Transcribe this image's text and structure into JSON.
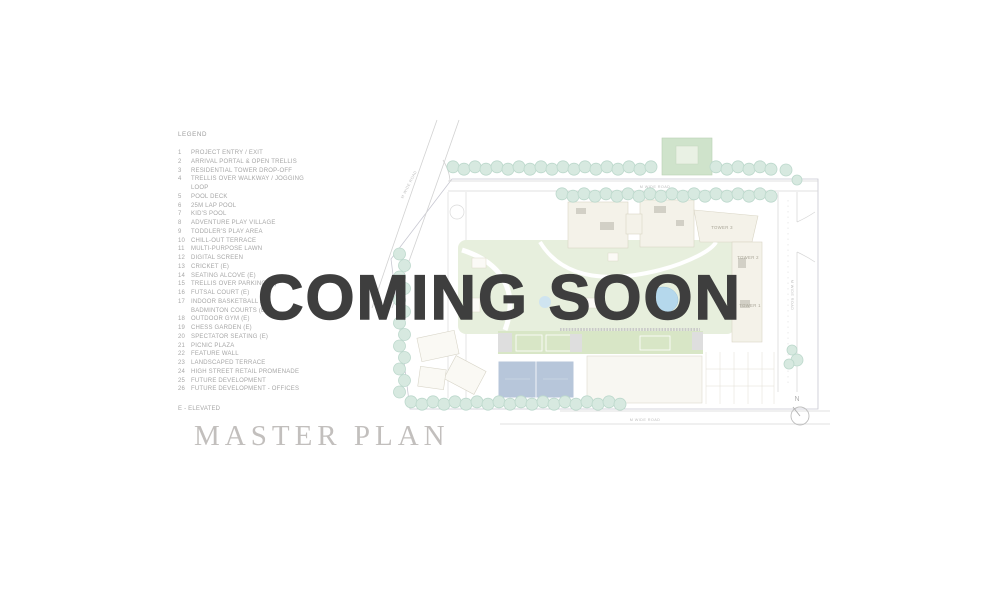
{
  "overlay": {
    "coming_soon": "COMING SOON"
  },
  "legend": {
    "heading": "LEGEND",
    "note": "E - ELEVATED",
    "items": [
      {
        "num": "1",
        "label": "PROJECT ENTRY / EXIT"
      },
      {
        "num": "2",
        "label": "ARRIVAL PORTAL & OPEN TRELLIS"
      },
      {
        "num": "3",
        "label": "RESIDENTIAL TOWER DROP-OFF"
      },
      {
        "num": "4",
        "label": "TRELLIS OVER WALKWAY / JOGGING LOOP"
      },
      {
        "num": "5",
        "label": "POOL DECK"
      },
      {
        "num": "6",
        "label": "25M LAP POOL"
      },
      {
        "num": "7",
        "label": "KID'S POOL"
      },
      {
        "num": "8",
        "label": "ADVENTURE PLAY VILLAGE"
      },
      {
        "num": "9",
        "label": "TODDLER'S PLAY AREA"
      },
      {
        "num": "10",
        "label": "CHILL-OUT TERRACE"
      },
      {
        "num": "11",
        "label": "MULTI-PURPOSE LAWN"
      },
      {
        "num": "12",
        "label": "DIGITAL SCREEN"
      },
      {
        "num": "13",
        "label": "CRICKET (E)"
      },
      {
        "num": "14",
        "label": "SEATING ALCOVE (E)"
      },
      {
        "num": "15",
        "label": "TRELLIS OVER PARKING (E)"
      },
      {
        "num": "16",
        "label": "FUTSAL COURT (E)"
      },
      {
        "num": "17",
        "label": "INDOOR BASKETBALL /",
        "label2": "BADMINTON COURTS (E)"
      },
      {
        "num": "18",
        "label": "OUTDOOR GYM (E)"
      },
      {
        "num": "19",
        "label": "CHESS GARDEN (E)"
      },
      {
        "num": "20",
        "label": "SPECTATOR SEATING (E)"
      },
      {
        "num": "21",
        "label": "PICNIC PLAZA"
      },
      {
        "num": "22",
        "label": "FEATURE WALL"
      },
      {
        "num": "23",
        "label": "LANDSCAPED TERRACE"
      },
      {
        "num": "24",
        "label": "HIGH STREET RETAIL PROMENADE"
      },
      {
        "num": "25",
        "label": "FUTURE DEVELOPMENT"
      },
      {
        "num": "26",
        "label": "FUTURE DEVELOPMENT - OFFICES"
      }
    ]
  },
  "plan": {
    "title": "MASTER PLAN",
    "tower_labels": {
      "t1": "TOWER 1",
      "t2": "TOWER 2",
      "t3": "TOWER 3"
    },
    "road_label": "M WIDE ROAD",
    "north_label": "N"
  },
  "colors": {
    "coming_soon_text": "#3e3e3e",
    "legend_text": "#a7a7a7",
    "master_title_text": "#c2bfbd",
    "tree_fill": "#d7e9e0",
    "tree_stroke": "#bcd8cc",
    "lawn": "#e7efdd",
    "court_green": "#d8e6c6",
    "court_blue": "#b7c6da",
    "pool_blue": "#b5d8ec",
    "building_cream": "#f4f2e9",
    "building_white": "#f8f7f2",
    "road_line": "#d4d4d4",
    "boundary": "#c8c8d2"
  }
}
